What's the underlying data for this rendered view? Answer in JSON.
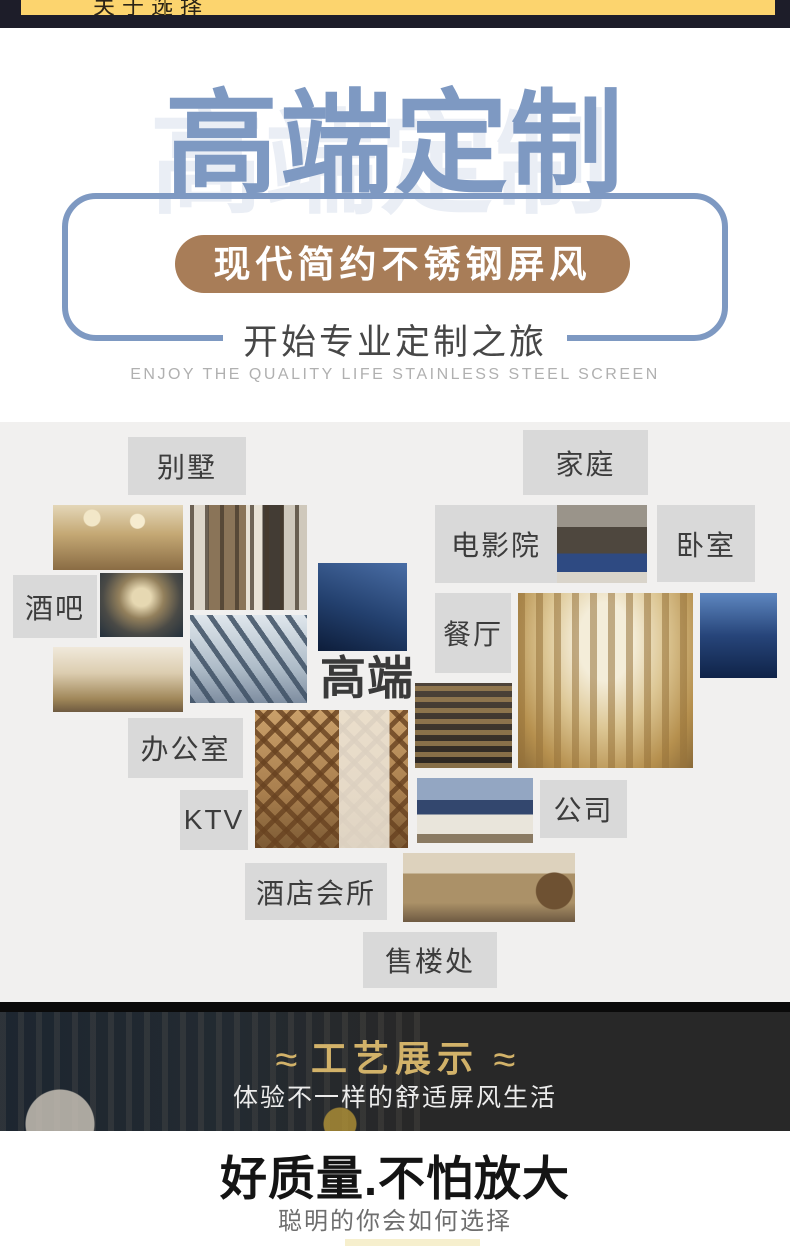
{
  "top_bar": {
    "tab_label": "关于选择"
  },
  "hero": {
    "title": "高端定制",
    "badge": "现代简约不锈钢屏风",
    "subtitle": "开始专业定制之旅",
    "tagline_en": "ENJOY THE QUALITY LIFE STAINLESS STEEL SCREEN"
  },
  "scenes": {
    "center_text": "高端",
    "labels": [
      "别墅",
      "家庭",
      "电影院",
      "卧室",
      "酒吧",
      "餐厅",
      "办公室",
      "KTV",
      "公司",
      "酒店会所",
      "售楼处"
    ]
  },
  "craft": {
    "flourish": "≈",
    "title": "工艺展示",
    "subtitle": "体验不一样的舒适屏风生活"
  },
  "quality": {
    "headline": "好质量.不怕放大",
    "subline": "聪明的你会如何选择"
  },
  "colors": {
    "accent_blue": "#7e99c2",
    "badge_brown": "#a87d58",
    "tab_yellow": "#fcd46e",
    "topbar_navy": "#1d1d29",
    "gold_text": "#d2b269",
    "label_gray": "#d9d9d9",
    "collage_bg": "#f1f0ef",
    "craft_bg": "#282828"
  }
}
